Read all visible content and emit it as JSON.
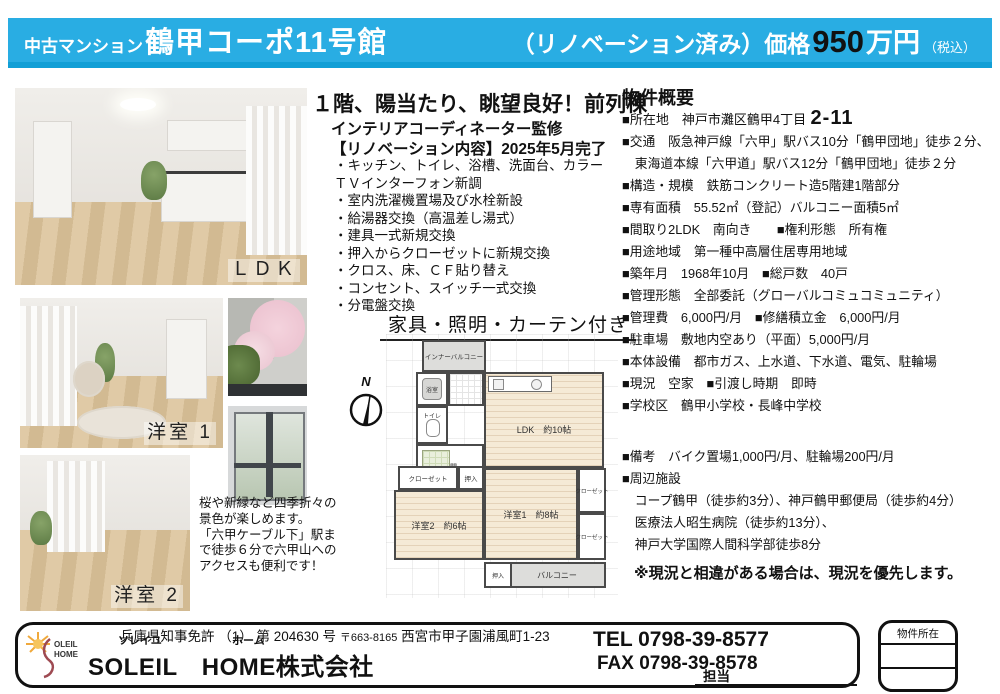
{
  "header": {
    "category": "中古マンション",
    "building": "鶴甲コーポ11号館",
    "reno_price": "（リノベーション済み）価格",
    "price_value": "950",
    "price_unit": "万円",
    "tax": "（税込）"
  },
  "photos": {
    "ldk": "ＬＤＫ",
    "room1": "洋室 1",
    "room2": "洋室 2"
  },
  "highlight": {
    "headline": "１階、陽当たり、眺望良好！前列棟",
    "supervision": "インテリアコーディネーター監修",
    "reno_title": "【リノベーション内容】2025年5月完了",
    "items": [
      "・キッチン、トイレ、浴槽、洗面台、カラー",
      "ＴＶインターフォン新調",
      "・室内洗濯機置場及び水栓新設",
      "・給湯器交換（高温差し湯式）",
      "・建具一式新規交換",
      "・押入からクローゼットに新規交換",
      "・クロス、床、ＣＦ貼り替え",
      "・コンセント、スイッチ一式交換",
      "・分電盤交換"
    ],
    "furniture_note": "家具・照明・カーテン付き"
  },
  "view_note_lines": [
    "桜や新緑など四季折々の",
    "景色が楽しめます。",
    "「六甲ケーブル下」駅ま",
    "で徒歩６分で六甲山への",
    "アクセスも便利です！"
  ],
  "floorplan": {
    "compass_n": "N",
    "inner_balcony": "インナーバルコニー",
    "bath": "浴室",
    "toilet": "トイレ",
    "entrance": "玄関",
    "closet_left": "クローゼット",
    "oshiire_left": "押入",
    "ldk": "LDK　約10帖",
    "room1": "洋室1　約8帖",
    "room2": "洋室2　約6帖",
    "closet_right1": "クローゼット",
    "closet_right2": "クローゼット",
    "oshiire_bottom": "押入",
    "balcony": "バルコニー"
  },
  "overview": {
    "title": "物件概要",
    "address_label": "■所在地　神戸市灘区鶴甲4丁目",
    "address_number": "2-11",
    "rows_a": [
      "■交通　阪急神戸線「六甲」駅バス10分「鶴甲団地」徒歩２分、",
      "　東海道本線「六甲道」駅バス12分「鶴甲団地」徒歩２分",
      "■構造・規模　鉄筋コンクリート造5階建1階部分",
      "■専有面積　55.52㎡（登記）バルコニー面積5㎡",
      "■間取り2LDK　南向き　　■権利形態　所有権",
      "■用途地域　第一種中高層住居専用地域",
      "■築年月　1968年10月　■総戸数　40戸",
      "■管理形態　全部委託（グローバルコミュコミュニティ）",
      "■管理費　6,000円/月　■修繕積立金　6,000円/月",
      "■駐車場　敷地内空あり（平面）5,000円/月",
      "■本体設備　都市ガス、上水道、下水道、電気、駐輪場",
      "■現況　空家　■引渡し時期　即時",
      "■学校区　鶴甲小学校・長峰中学校"
    ],
    "rows_b": [
      "■備考　バイク置場1,000円/月、駐輪場200円/月",
      "■周辺施設",
      "　コープ鶴甲（徒歩約3分）、神戸鶴甲郵便局（徒歩約4分）",
      "　医療法人昭生病院（徒歩約13分）、",
      "　神戸大学国際人間科学部徒歩8分"
    ],
    "note": "※現況と相違がある場合は、現況を優先します。"
  },
  "footer": {
    "license": "兵庫県知事免許 （1） 第 204630 号",
    "postal": "〒663-8165",
    "office_address": "西宮市甲子園浦風町1-23",
    "furigana_soleil": "ソレイユ",
    "furigana_home": "ホーム",
    "company": "SOLEIL　HOME株式会社",
    "tel": "TEL 0798-39-8577",
    "fax": "FAX 0798-39-8578",
    "staff_label": "担当",
    "property_location_label": "物件所在"
  }
}
